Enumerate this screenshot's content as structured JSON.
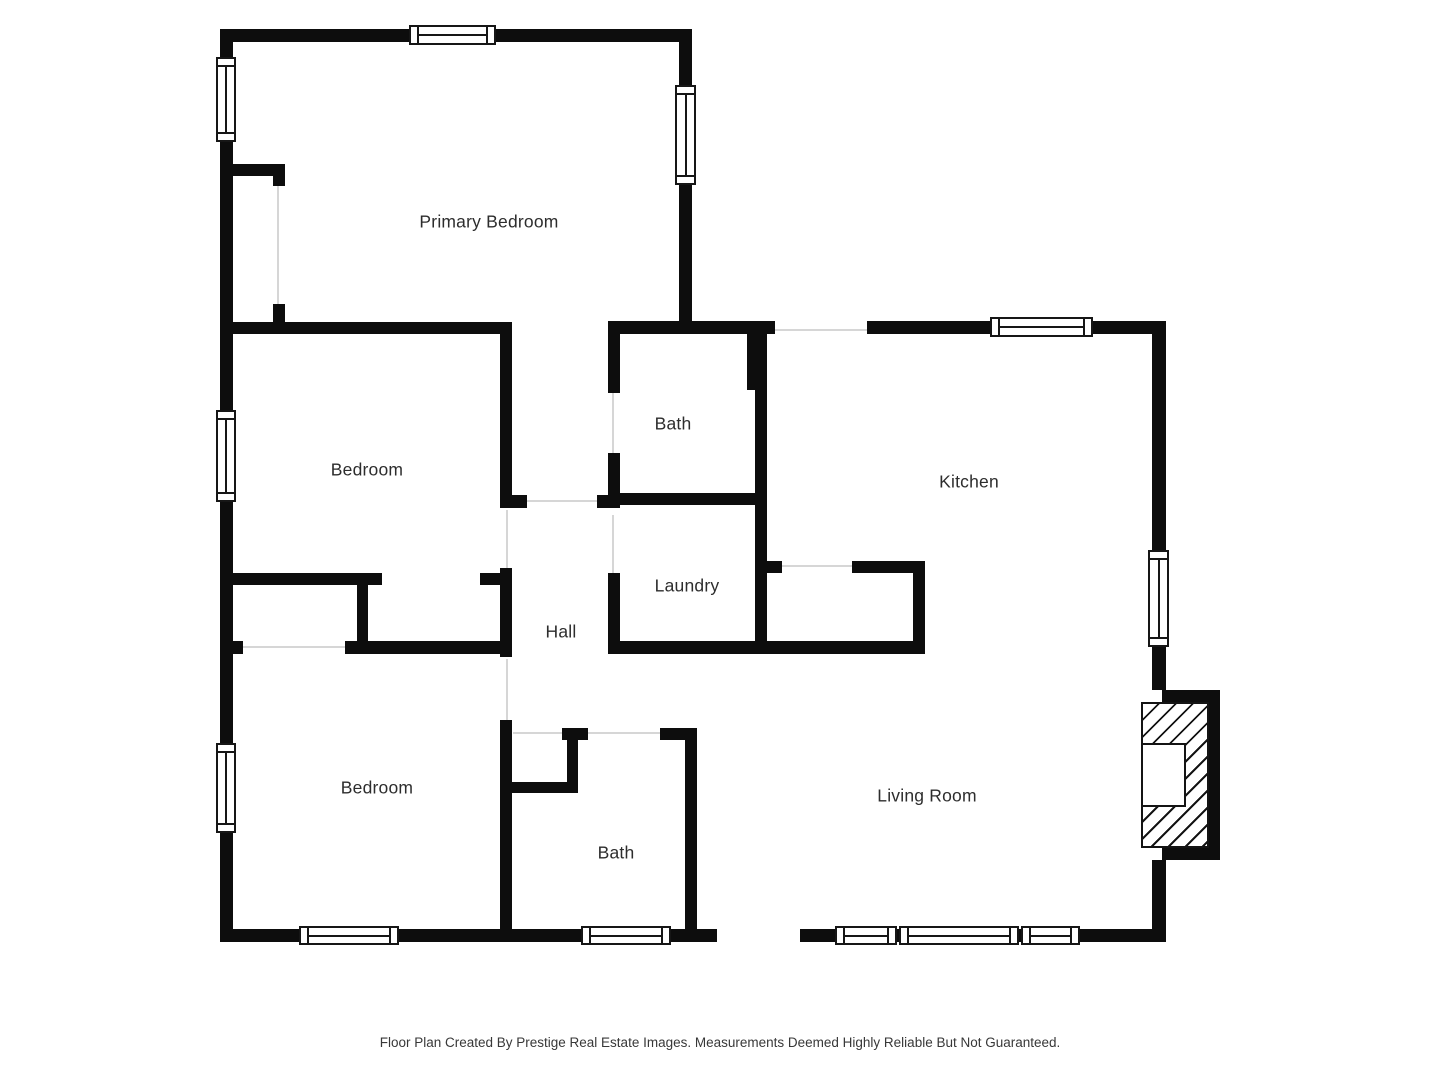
{
  "rooms": {
    "primary_bedroom": "Primary Bedroom",
    "bedroom_middle": "Bedroom",
    "bath_upper": "Bath",
    "kitchen": "Kitchen",
    "laundry": "Laundry",
    "hall": "Hall",
    "bedroom_lower": "Bedroom",
    "bath_lower": "Bath",
    "living_room": "Living Room"
  },
  "caption": "Floor Plan Created By Prestige Real Estate Images. Measurements Deemed Highly Reliable But Not Guaranteed.",
  "colors": {
    "wall": "#0d0d0d",
    "background": "#ffffff",
    "label_text": "#2d2d2d",
    "door_threshold": "#d6d6d6",
    "fireplace_hatch": "#141414"
  }
}
